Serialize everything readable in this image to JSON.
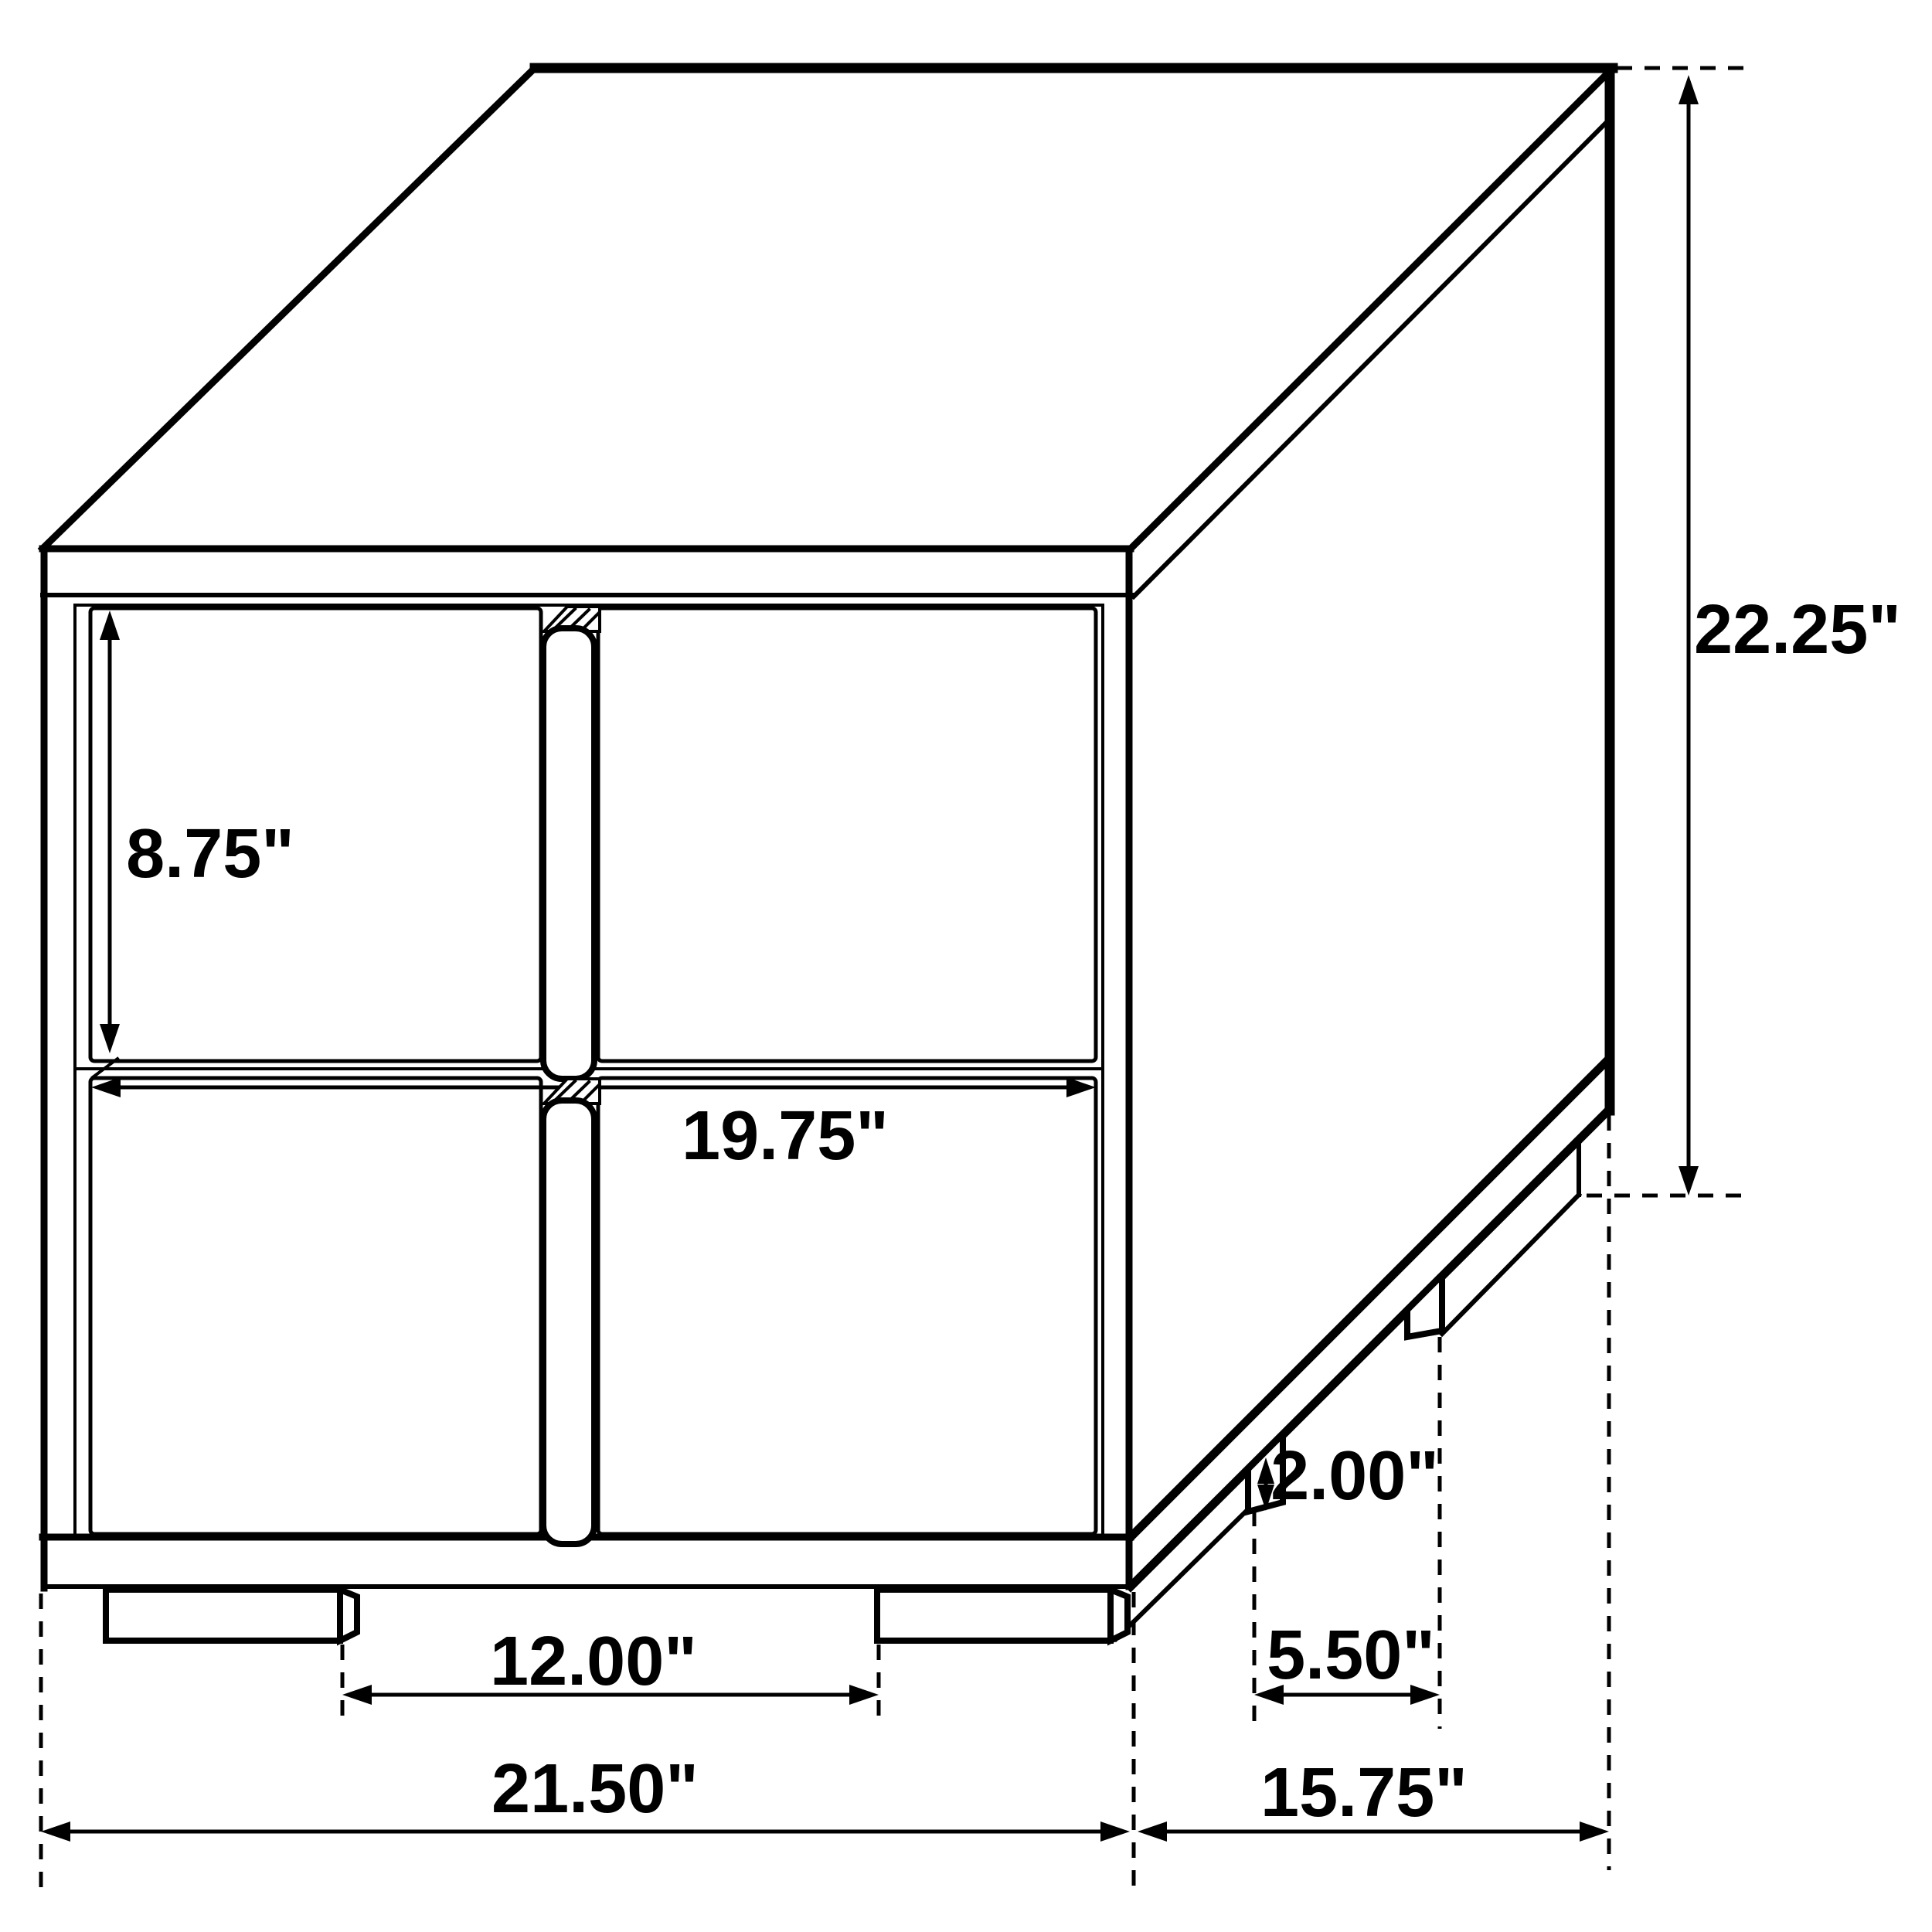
{
  "diagram": {
    "subject": "two-drawer nightstand isometric line drawing with dimensions",
    "background_color": "#ffffff",
    "line_color": "#000000",
    "unit": "inches",
    "labels": {
      "drawer_front_height": "8.75\"",
      "drawer_front_width": "19.75\"",
      "overall_height": "22.25\"",
      "leg_height": "2.00\"",
      "front_leg_spacing": "12.00\"",
      "side_leg_spacing": "5.50\"",
      "overall_width": "21.50\"",
      "overall_depth": "15.75\""
    }
  }
}
